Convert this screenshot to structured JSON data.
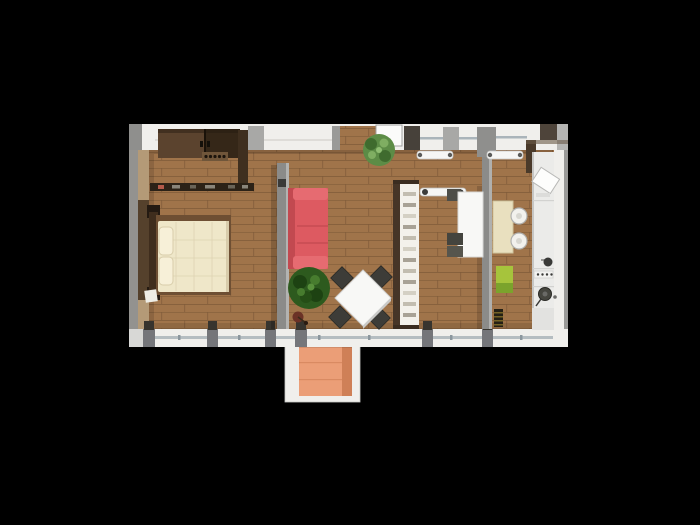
{
  "scene": {
    "type": "3d-apartment-floor-plan-render",
    "background": "#000000",
    "colors": {
      "background": "#000000",
      "floor": "#a0744a",
      "floor_line": "#7e5a38",
      "wall_white": "#f0efec",
      "wall_tan": "#b49a77",
      "wall_gray": "#93928f",
      "pillar_gray": "#a8a8a6",
      "wall_dark": "#463527",
      "partition": "#8b8b89",
      "glazing": "#aab4ba",
      "sofa": "#dd5a61",
      "sofa_dark": "#c24950",
      "sofa_light": "#e66b71",
      "bed_frame": "#6e4f33",
      "duvet": "#efe7c9",
      "pillow": "#f7f0d8",
      "wardrobe_dark": "#352718",
      "wardrobe_light": "#5b432e",
      "sideboard": "#2c2217",
      "shelf_white": "#f3f1eb",
      "plant_dark": "#2d5a1e",
      "plant_light": "#5c8c46",
      "table_white": "#f8f8f6",
      "chair_dark": "#3d3c38",
      "cream": "#e9e0bf",
      "counter": "#ebebe9",
      "appliance_dark": "#46463f",
      "green_accent": "#a6c43c",
      "radiator_white": "#f6f6f4",
      "balcony_floor": "#eb9e77",
      "balcony_shade": "#cf8057"
    },
    "rooms": {
      "bedroom": {
        "name": "bedroom",
        "furniture": [
          "wardrobe",
          "knob-rack",
          "sideboard",
          "double-bed",
          "pillows",
          "bedside-object"
        ]
      },
      "living_room": {
        "name": "living-room",
        "furniture": [
          "red-sofa",
          "large-plant",
          "floor-lamp",
          "square-dining-table",
          "dining-chairs-x4"
        ]
      },
      "entrance_hall": {
        "name": "entrance-hall",
        "furniture": [
          "entrance-door",
          "entrance-plant",
          "bookshelf-divider",
          "radiator"
        ]
      },
      "dining_nook": {
        "name": "dining-nook",
        "furniture": [
          "wall-table",
          "dark-chairs-x3"
        ]
      },
      "kitchen": {
        "name": "kitchen",
        "furniture": [
          "breakfast-table",
          "round-chairs-x2",
          "green-stool",
          "striped-bin",
          "counter",
          "fridge",
          "sink",
          "knob-panel",
          "cooktop-burner"
        ]
      },
      "balcony": {
        "name": "balcony",
        "furniture": []
      }
    },
    "openings": {
      "windows_top": 4,
      "windows_bottom": 6,
      "entrance": "top-center",
      "balcony_access": "bottom-center"
    }
  }
}
